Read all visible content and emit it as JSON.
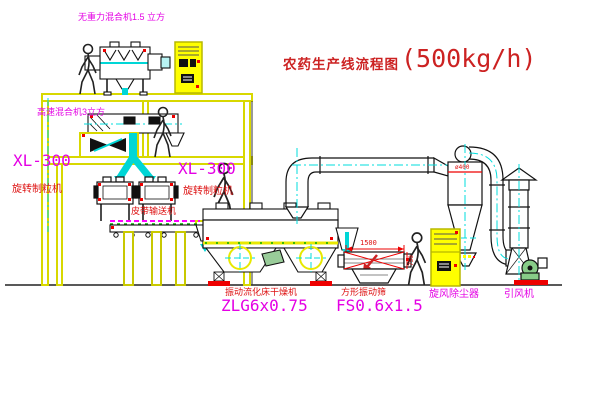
{
  "title": {
    "main": "农药生产线流程图",
    "capacity": "(500kg/h)"
  },
  "equipment_labels": {
    "top_mixer": "无重力混合机1.5 立方",
    "mid_mixer": "高速混合机3立方",
    "granulator_left_model": "XL-300",
    "granulator_left_name": "旋转制粒机",
    "granulator_right_model": "XL-300",
    "granulator_right_name": "旋转制粒机",
    "belt_conveyor": "皮带输送机",
    "dryer_name": "振动流化床干燥机",
    "dryer_model": "ZLG6x0.75",
    "screen_name": "方形振动筛",
    "screen_model": "FS0.6x1.5",
    "cyclone": "旋风除尘器",
    "fan": "引风机"
  },
  "dimensions": {
    "screen_width": "1500",
    "screen_height": "750",
    "cyclone_diameter": "ø400"
  },
  "colors": {
    "structure_yellow": "#e0e000",
    "cabinet_yellow": "#ffff00",
    "centerline_cyan": "#00dddd",
    "pipe_cyan": "#00d6d6",
    "text_red": "#dd1111",
    "text_magenta": "#e400e4",
    "accent_green": "#00aa00",
    "accent_red": "#ee0000",
    "title_red": "#cc2222"
  }
}
